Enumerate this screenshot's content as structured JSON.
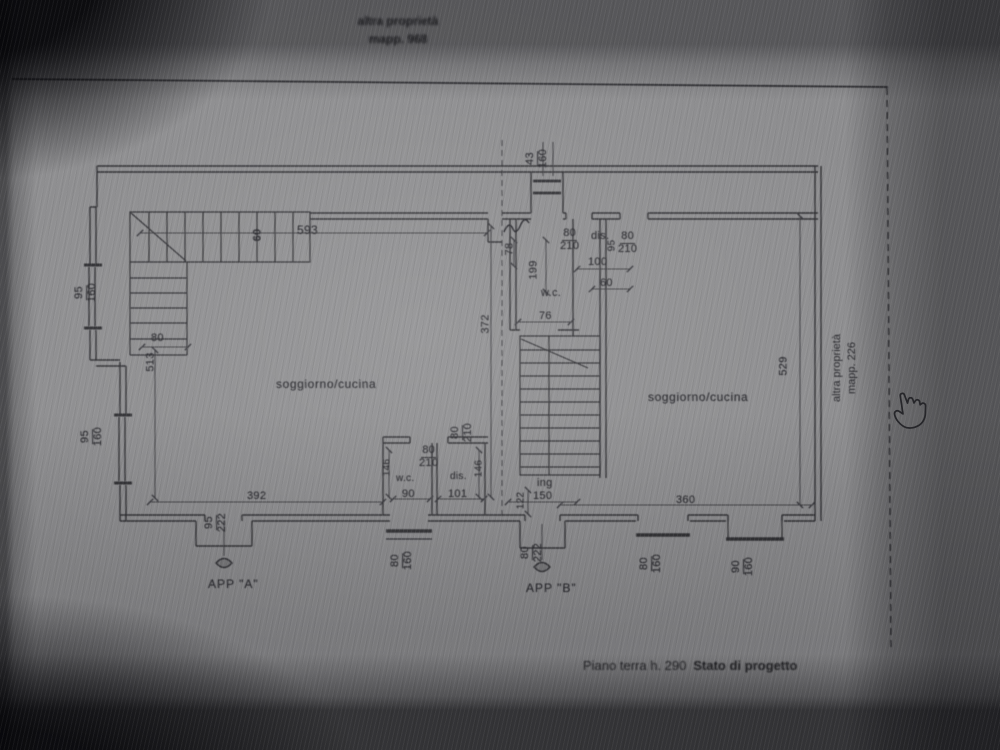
{
  "top_note": {
    "line1": "altra proprietà",
    "line2": "mapp. 968"
  },
  "side_note": {
    "line1": "altra proprietà",
    "line2": "mapp. 226"
  },
  "footer": {
    "text": "Piano terra h. 290",
    "bold": "Stato di progetto"
  },
  "rooms": {
    "living_a": "soggiorno/cucina",
    "living_b": "soggiorno/cucina",
    "wc_a": "w.c.",
    "wc_b": "w.c.",
    "dis_a": "dis.",
    "dis_b": "dis.",
    "entry_b": "ing"
  },
  "apartments": {
    "a": "APP \"A\"",
    "b": "APP \"B\""
  },
  "dims": {
    "stair_a_length": "593",
    "stair_a_width": "60",
    "stair_a_exit": "80",
    "wall_left_height": "513",
    "win_left_top_w": "95",
    "win_left_top_h": "160",
    "win_left_bot_w": "95",
    "win_left_bot_h": "160",
    "room_a_width": "392",
    "door_a_w": "95",
    "door_a_h": "222",
    "mid_height": "372",
    "win_top_w": "43",
    "win_top_h": "160",
    "niche_depth": "78",
    "wc_b_length": "199",
    "wc_b_width": "76",
    "door_b1_w": "80",
    "door_b1_h": "210",
    "dis_b_height": "95",
    "door_b2_w": "80",
    "door_b2_h": "210",
    "dis_b_width": "100",
    "dis_b_depth": "60",
    "wc_a_depth": "146",
    "wc_a_width": "90",
    "dis_a_depth": "146",
    "dis_a_width": "101",
    "door_wc_a_w": "80",
    "door_wc_a_h": "210",
    "door_dis_a_w": "80",
    "door_dis_a_h": "210",
    "win_wc_a_w": "80",
    "win_wc_a_h": "160",
    "entry_b_depth": "122",
    "entry_b_width": "150",
    "door_b_w": "80",
    "door_b_h": "222",
    "room_b_width": "360",
    "room_b_height": "529",
    "win_b1_w": "80",
    "win_b1_h": "160",
    "win_b2_w": "90",
    "win_b2_h": "160"
  }
}
